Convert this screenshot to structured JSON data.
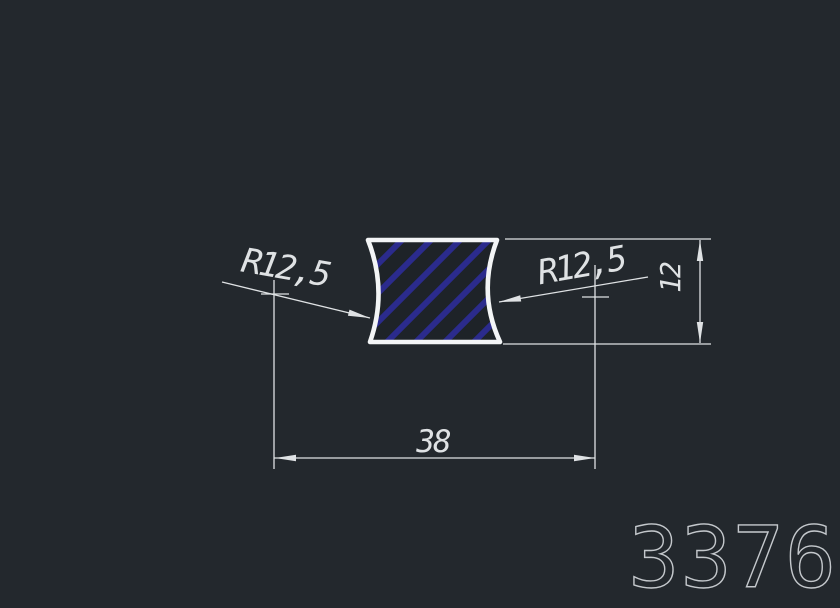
{
  "drawing": {
    "profile_number": "3376",
    "dimensions": {
      "radius_left": "R12,5",
      "radius_right": "R12,5",
      "height": "12",
      "width": "38"
    },
    "colors": {
      "background": "#23282d",
      "lines": "#dfe2e4",
      "outline": "#f3f5f6",
      "hatch": "#2b2b8c",
      "interior": "#1e2328",
      "title": "#c4c8cc"
    }
  }
}
